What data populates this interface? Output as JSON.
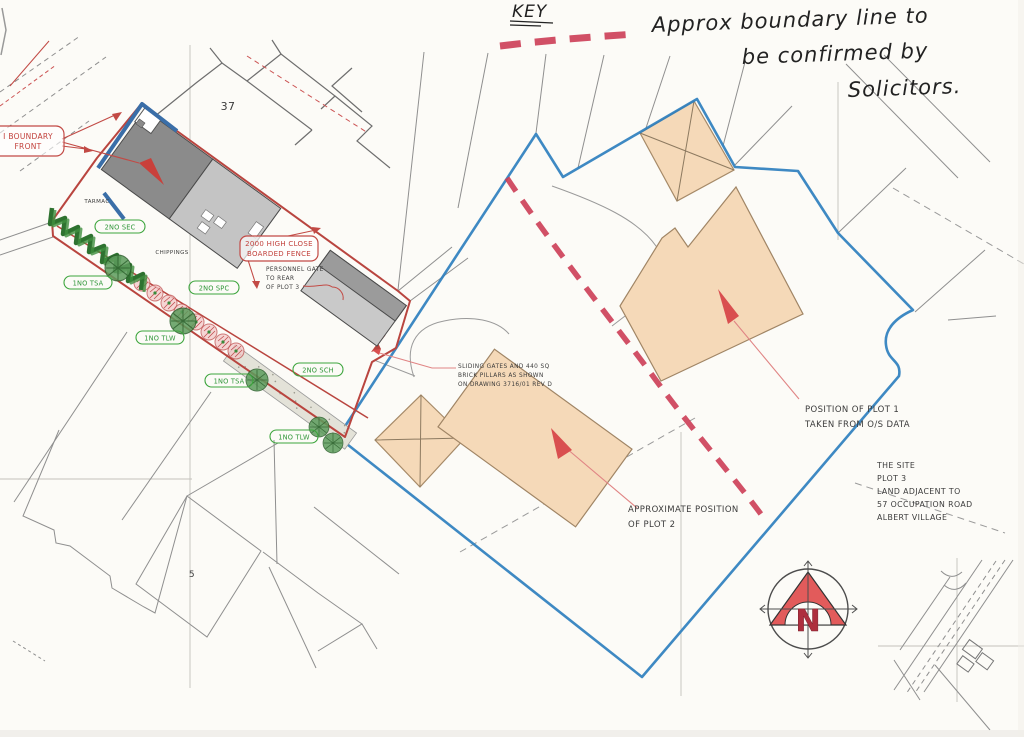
{
  "colors": {
    "paper": "#fcfbf7",
    "blue_boundary": "#2e7fbe",
    "red_plot": "#b9453f",
    "marker_red": "#cc3d55",
    "tan_fill": "#f5d9b8",
    "tan_edge": "#a68a68",
    "grey_line": "#8f8f8f",
    "green_label": "#2f9638",
    "pink_leader": "#e08484"
  },
  "key": {
    "title": "KEY",
    "note_lines": [
      "Approx boundary line to",
      "be confirmed by",
      "Solicitors."
    ]
  },
  "annotations": {
    "boundary_front_lines": [
      "I BOUNDARY",
      "FRONT"
    ],
    "fence_lines": [
      "2000 HIGH CLOSE",
      "BOARDED FENCE"
    ],
    "personnel_gate_lines": [
      "PERSONNEL GATE",
      "TO REAR",
      "OF PLOT 3"
    ],
    "sliding_gates_lines": [
      "SLIDING GATES AND 440 SQ",
      "BRICK PILLARS AS SHOWN",
      "ON DRAWING 3716/01 REV D"
    ],
    "plot1_lines": [
      "POSITION OF PLOT 1",
      "TAKEN FROM O/S DATA"
    ],
    "plot2_lines": [
      "APPROXIMATE POSITION",
      "OF PLOT 2"
    ],
    "site_title_lines": [
      "THE SITE",
      "PLOT 3",
      "LAND ADJACENT TO",
      "57 OCCUPATION ROAD",
      "ALBERT VILLAGE"
    ],
    "tarmac": "TARMAC",
    "chippings": "CHIPPINGS",
    "house_number": "37",
    "parcel_number": "5",
    "north_letter": "N"
  },
  "planting_labels": [
    "2NO SEC",
    "1NO TSA",
    "2NO SPC",
    "1NO TLW",
    "2NO SCH",
    "1NO TSA",
    "1NO TLW"
  ]
}
